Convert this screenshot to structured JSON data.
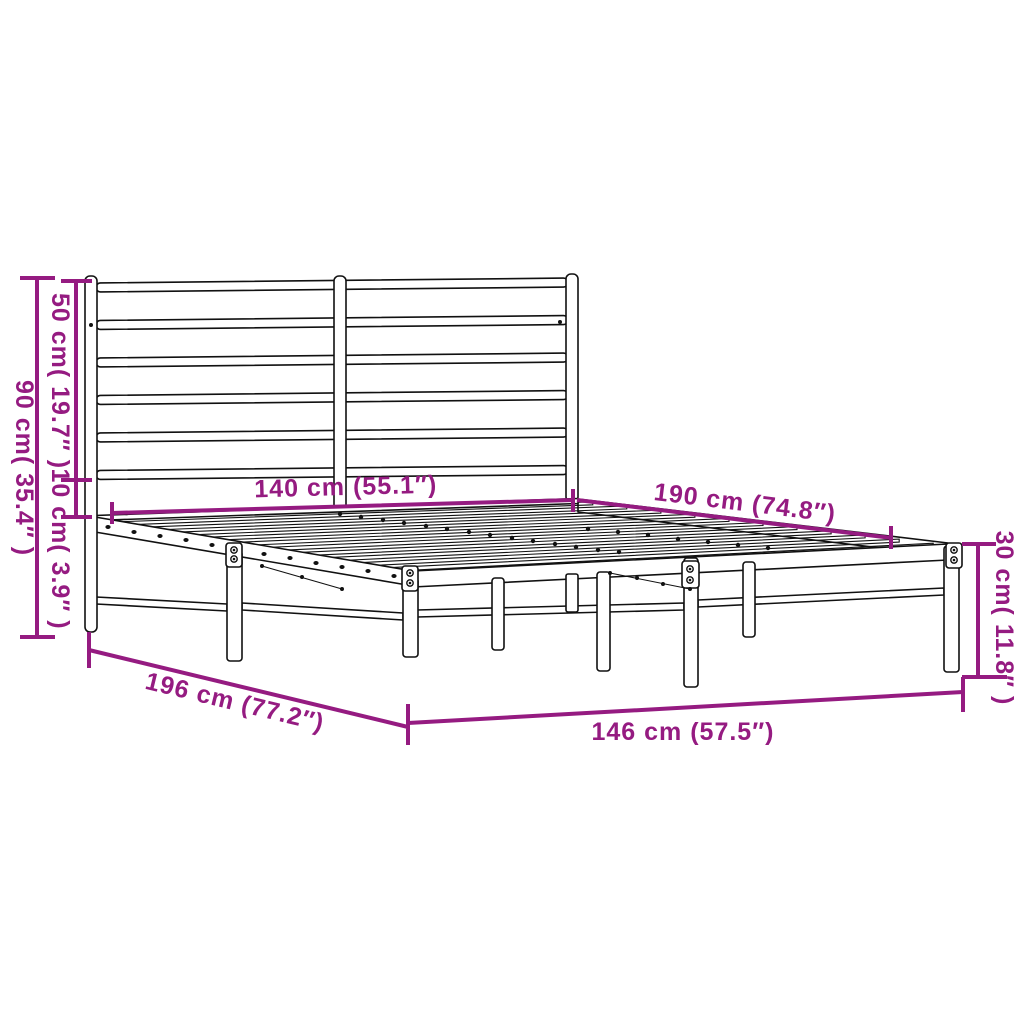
{
  "diagram": {
    "kind": "product-dimension-diagram",
    "subject": "metal-bed-frame-with-headboard",
    "colors": {
      "accent": "#951b81",
      "line": "#111111",
      "background": "#ffffff"
    },
    "labels": {
      "total_height": "90 cm( 35.4″ )",
      "headboard_height": "50 cm( 19.7″ )",
      "clearance": "10 cm( 3.9″ )",
      "inner_width": "140 cm (55.1″)",
      "inner_length": "190 cm (74.8″)",
      "frame_height": "30 cm( 11.8″ )",
      "total_length": "196 cm (77.2″)",
      "total_width": "146 cm (57.5″)"
    }
  }
}
